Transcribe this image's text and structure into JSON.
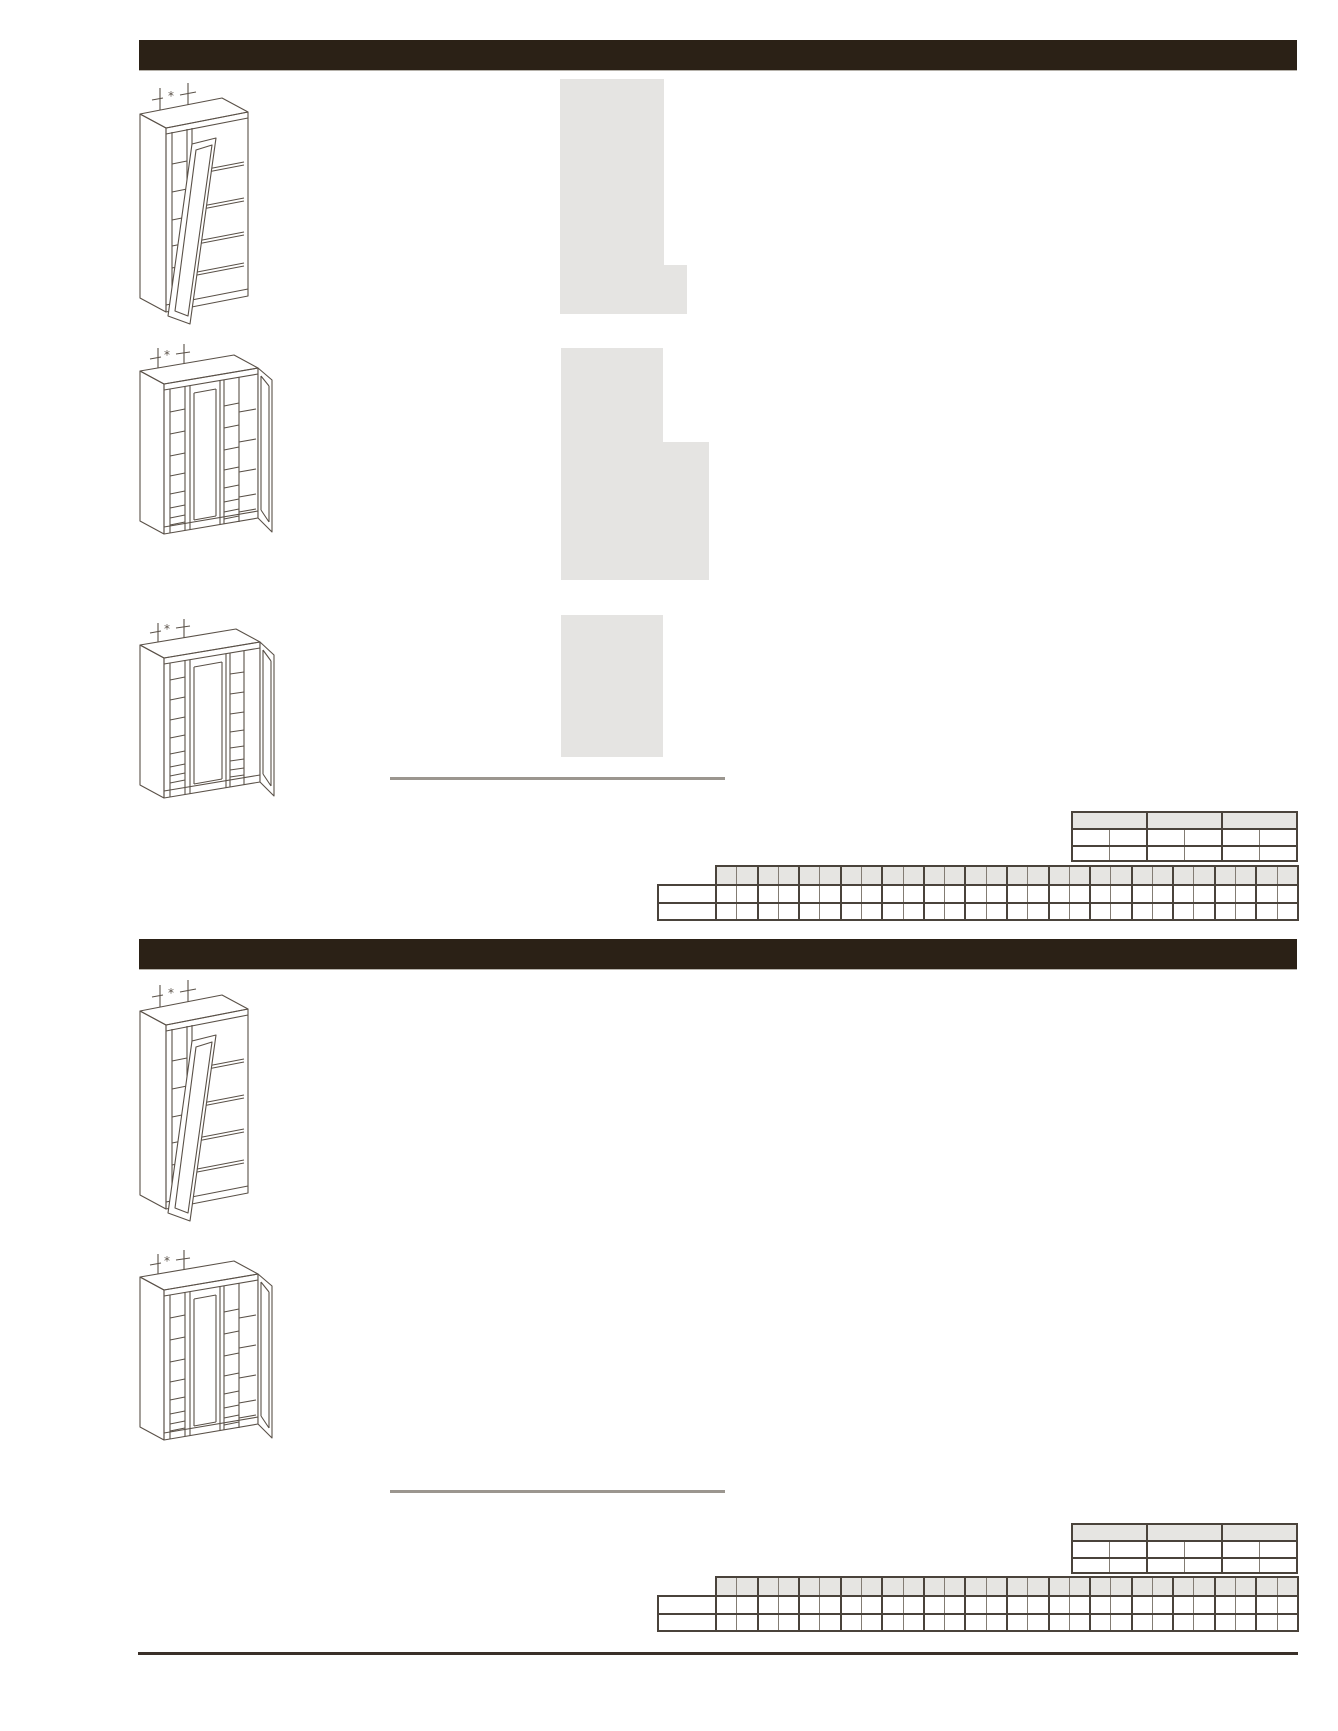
{
  "document": {
    "kind": "cabinet-specification-catalog-page",
    "visible_text_note": "page contains no legible body text; only dimension asterisk markers"
  },
  "colors": {
    "header_bar": "#2b2116",
    "placeholder_block": "#e5e4e2",
    "divider_line": "#9b968f",
    "table_border_dark": "#4a433b",
    "table_border_mid": "#837c73",
    "table_header_fill": "#e6e5e2",
    "drawing_stroke": "#5a5148",
    "bottom_rule": "#3a3029"
  },
  "sections": [
    {
      "title_text": "",
      "cabinets": [
        {
          "type": "wall-cabinet-two-door-one-open",
          "marker": "*"
        },
        {
          "type": "wall-cabinet-three-section-right-door-open",
          "marker": "*"
        },
        {
          "type": "wall-cabinet-wide-three-section-right-door-open",
          "marker": "*"
        }
      ],
      "placeholder_block_count": 5
    },
    {
      "title_text": "",
      "cabinets": [
        {
          "type": "wall-cabinet-two-door-one-open",
          "marker": "*"
        },
        {
          "type": "wall-cabinet-three-section-right-door-open",
          "marker": "*"
        }
      ],
      "placeholder_block_count": 0
    }
  ],
  "tables": {
    "spec": {
      "header_columns": 3,
      "sub_columns": 6,
      "data_rows": 2,
      "cell_text": ""
    },
    "matrix": {
      "columns": 28,
      "data_rows": 2,
      "label_rows": 2,
      "cell_text": ""
    }
  }
}
